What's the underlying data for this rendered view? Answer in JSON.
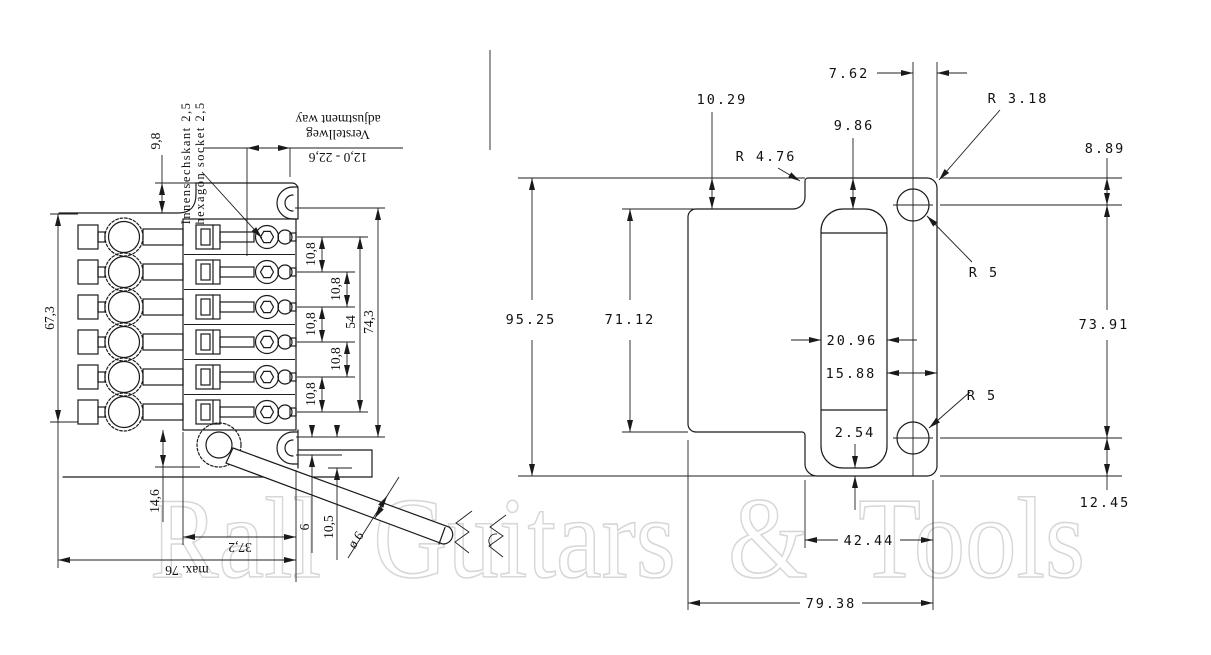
{
  "watermark": "Rall Guitars & Tools",
  "left_view": {
    "dims": {
      "d9_8": "9,8",
      "d67_3": "67,3",
      "d14_6": "14,6",
      "d37_2": "37,2",
      "dmax76": "max. 76",
      "d6": "6",
      "d10_5": "10,5",
      "darm_dia": "ø 6",
      "d54": "54",
      "d74_3": "74,3",
      "drange": "12,0 - 22,6",
      "spacing": [
        "10,8",
        "10,8",
        "10,8",
        "10,8",
        "10,8"
      ]
    },
    "notes": {
      "hex_de": "Innensechskant 2,5",
      "hex_en": "hexagon socket 2,5",
      "adj_de": "Verstellweg",
      "adj_en": "adjustment way"
    }
  },
  "right_view": {
    "dims": {
      "d7_62": "7.62",
      "d10_29": "10.29",
      "d9_86": "9.86",
      "r4_76": "R 4.76",
      "r3_18": "R 3.18",
      "d8_89": "8.89",
      "d95_25": "95.25",
      "d71_12": "71.12",
      "d20_96": "20.96",
      "d15_88": "15.88",
      "r5_top": "R 5",
      "r5_bottom": "R 5",
      "d73_91": "73.91",
      "d2_54": "2.54",
      "d12_45": "12.45",
      "d42_44": "42.44",
      "d79_38": "79.38"
    }
  }
}
